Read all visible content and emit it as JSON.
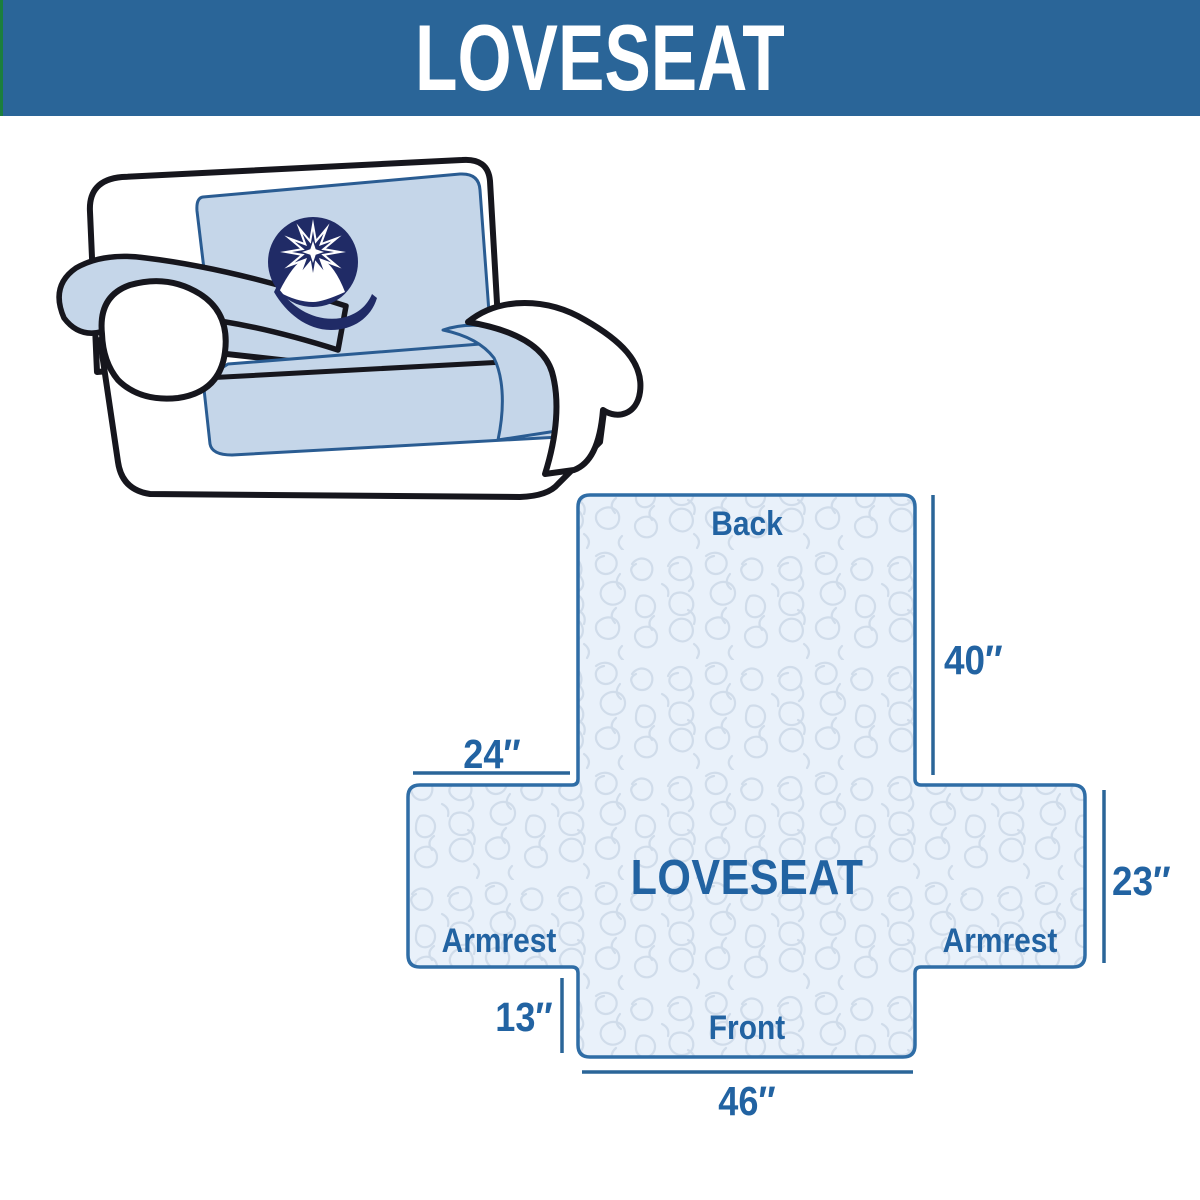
{
  "header": {
    "title": "LOVESEAT"
  },
  "illustration": {
    "logo_icon": "q-starburst-logo",
    "description_labels": {}
  },
  "diagram": {
    "center_label": "LOVESEAT",
    "back_label": "Back",
    "front_label": "Front",
    "armrest_left_label": "Armrest",
    "armrest_right_label": "Armrest",
    "dim_back_height": "40″",
    "dim_armrest_width": "24″",
    "dim_armrest_height": "23″",
    "dim_front_height": "13″",
    "dim_front_width": "46″"
  },
  "colors": {
    "header_bg": "#2a6598",
    "accent_strip_green": "#1b7e3e",
    "header_text": "#ffffff",
    "diagram_outline": "#2f6da6",
    "diagram_fill": "#e9f1fa",
    "pattern_line": "#d0dcea",
    "label_text": "#2263a2",
    "cover_blue": "#c5d6e9",
    "cover_edge_blue": "#2a5c92",
    "logo_navy": "#202b66",
    "sofa_outline": "#16161d"
  }
}
